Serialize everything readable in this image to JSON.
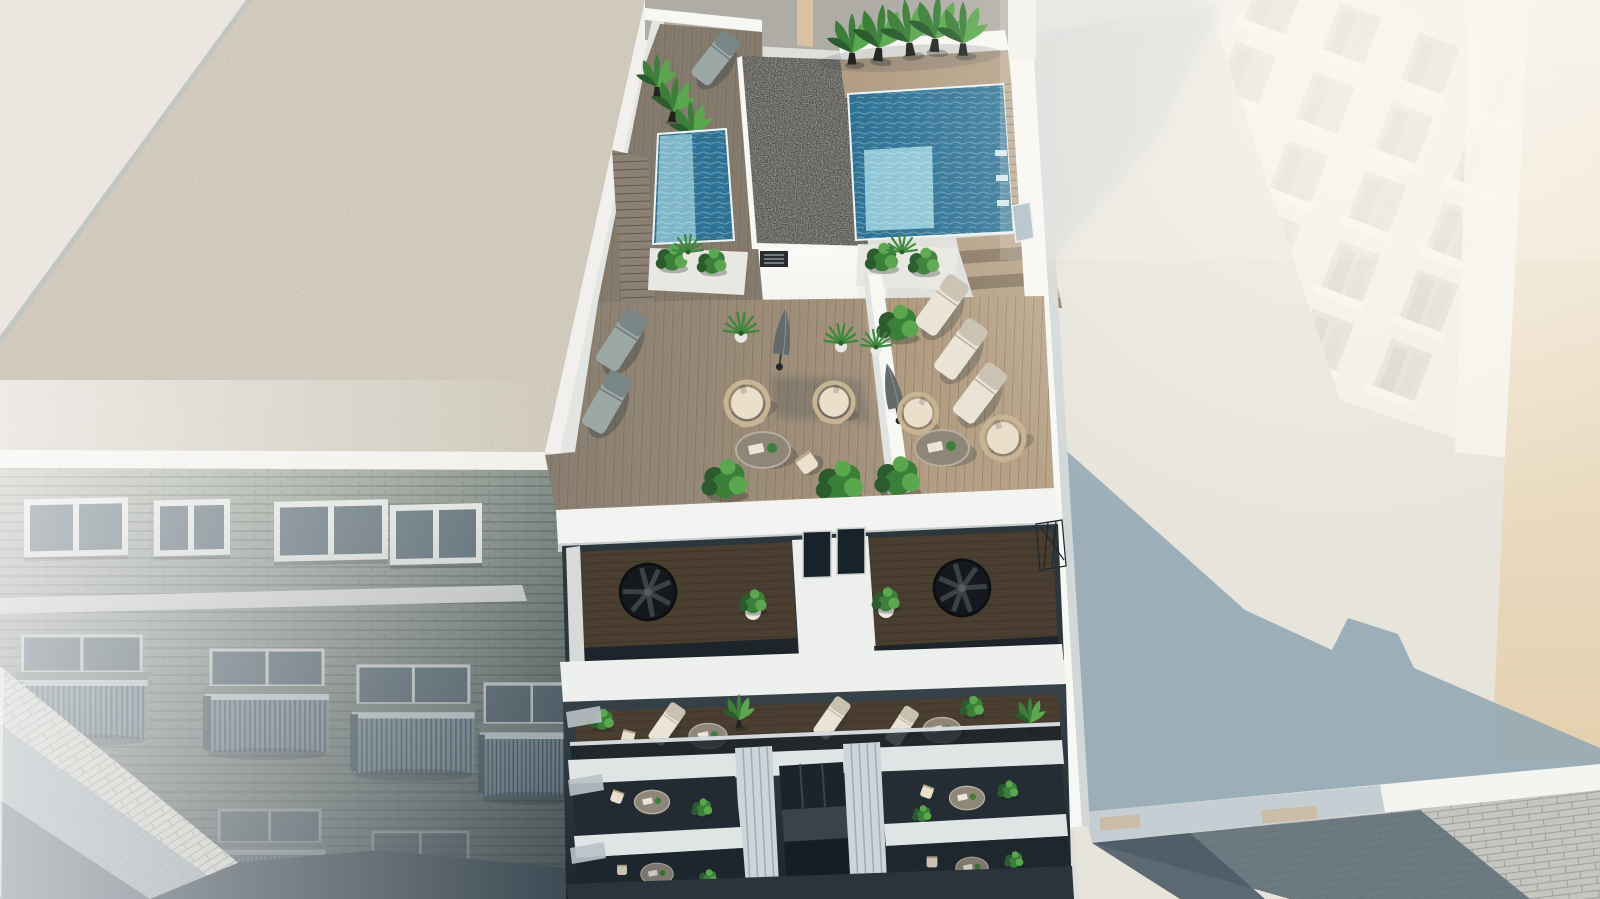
{
  "scene": {
    "description": "Aerial 3D architectural rendering of a modern white apartment building with a rooftop terrace, two plunge pools, wooden sun decks, lounge furniture, spiral staircases and plants, flanked by a brick neighbour building on the left, a tall white building and low flat roof on the right, and shadowed streets below.",
    "main_building": {
      "rooftop_pools": 2,
      "banana_plants": 8,
      "sun_loungers_terrace": 6,
      "hanging_egg_chairs": 4,
      "round_tables": 2,
      "parasols": 2,
      "spiral_staircases": 2,
      "planter_boxes": 3,
      "balcony_floors_visible": 4
    },
    "neighbor_building_left": {
      "roof_type": "gravel",
      "windows_upper_row": 4,
      "balconies_visible": 7
    },
    "right_side": {
      "tall_white_building": 1,
      "flat_roof_with_shadow": 1,
      "warm_side_wall": 1
    },
    "streets_visible": 2
  },
  "palette": {
    "canvas_base": "#dfe0dc",
    "white_bright": "#f7f7f3",
    "white_soft": "#eff0ec",
    "white_shade": "#d2d8d8",
    "slab_cool": "#dfe4e5",
    "gravel_light": "#d6cfc2",
    "gravel_trim": "#f1f0ec",
    "topleft_wall": "#ebe7e0",
    "neighbor_facade_top": "#b9bcb2",
    "neighbor_facade_low": "#6d7a7a",
    "window_frame": "#e9ebe7",
    "window_glass": "#64747c",
    "balcony_rail": "#8ea1ab",
    "street_lit": "#c6c6c0",
    "street_shadow": "#5d6c75",
    "street_dark": "#3f4c55",
    "deck_shaded": "#837a6c",
    "deck_lit": "#b29e84",
    "pool_deep": "#2e7396",
    "pool_mid": "#5ba4bc",
    "pool_light": "#8fc6d6",
    "core_gravel": "#4e4d49",
    "core_face": "#f6f7f3",
    "plant_dark": "#2a5c2e",
    "plant_mid": "#3b8039",
    "plant_light": "#5aa84e",
    "pot_black": "#20241f",
    "pot_white": "#e9e7e1",
    "lounger_cream": "#e9e4d6",
    "lounger_gray": "#9ca8a6",
    "rattan": "#c7b493",
    "cushion": "#eadfca",
    "umbrella_gray": "#646a6c",
    "table_top": "#8f867a",
    "facade_dark": "#313b43",
    "glass_dark": "#18222a",
    "wood_dark": "#4a3e31",
    "pilaster": "#ccd5d9",
    "roof_right_lit": "#e7e4db",
    "roof_right_shadow": "#93a9b4",
    "tower_white": "#f1eee8",
    "tower_window": "#e0dcd3",
    "wall_warm": "#e7d6ba",
    "beige_strip": "#d9c2a0"
  }
}
